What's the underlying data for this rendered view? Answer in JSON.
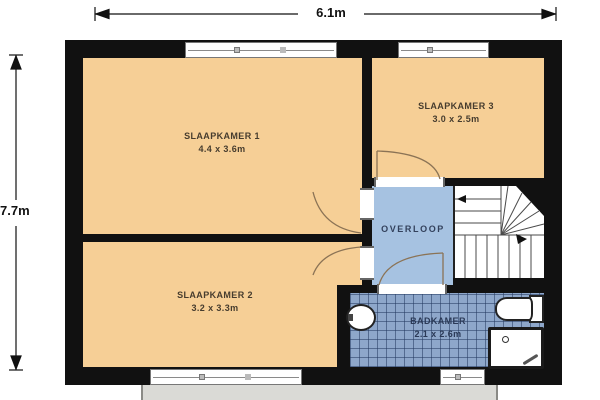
{
  "plan": {
    "type": "floor-plan-upper-storey",
    "dimensions": {
      "width_label": "6.1m",
      "height_label": "7.7m"
    },
    "rooms": [
      {
        "id": "slaapkamer-1",
        "name": "SLAAPKAMER 1",
        "size": "4.4 x 3.6m"
      },
      {
        "id": "slaapkamer-2",
        "name": "SLAAPKAMER 2",
        "size": "3.2 x 3.3m"
      },
      {
        "id": "slaapkamer-3",
        "name": "SLAAPKAMER 3",
        "size": "3.0 x 2.5m"
      },
      {
        "id": "overloop",
        "name": "OVERLOOP",
        "size": ""
      },
      {
        "id": "badkamer",
        "name": "BADKAMER",
        "size": "2.1 x 2.6m"
      }
    ],
    "fixtures": [
      "sink-icon",
      "toilet-icon",
      "shower-icon",
      "winder-staircase-icon"
    ],
    "features": [
      "4 windows",
      "5 interior doors",
      "winder staircase with direction arrows"
    ],
    "colors": {
      "wall": "#111111",
      "bedroom_fill": "#f6cf96",
      "landing_fill": "#a6c2e1",
      "bathroom_tile": "#8ea7ca",
      "porch": "#dadad6",
      "door_arc": "#8b7355"
    }
  }
}
